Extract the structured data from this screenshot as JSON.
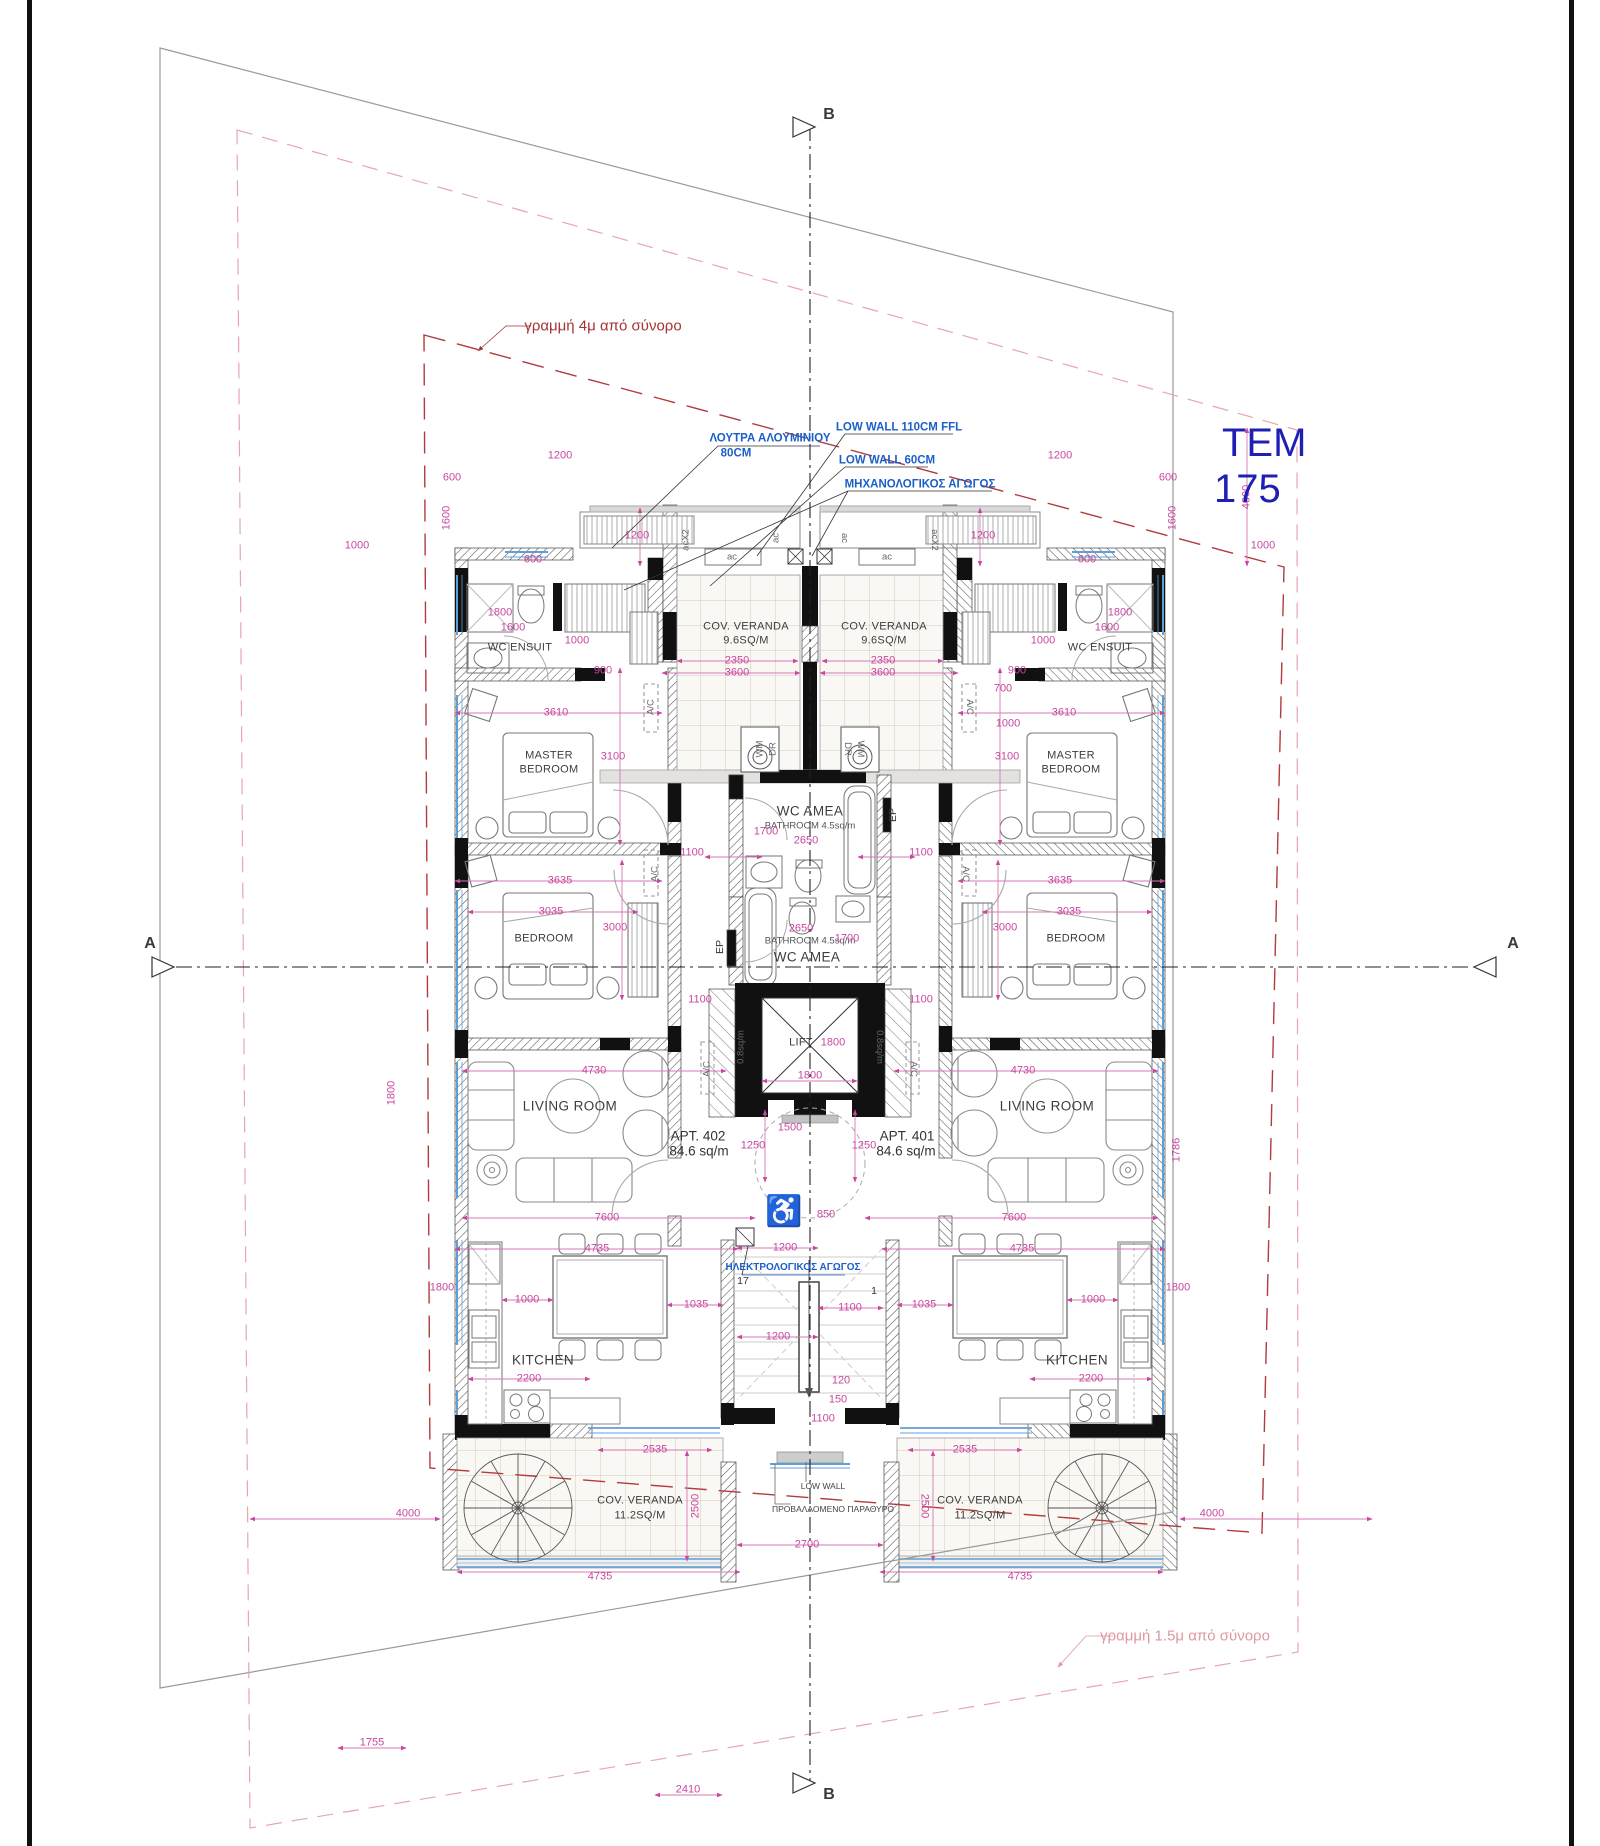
{
  "title": {
    "tem": "TEM",
    "lot_number": "175"
  },
  "apartments": [
    {
      "id": "APT. 402",
      "area": "84.6 sq/m"
    },
    {
      "id": "APT. 401",
      "area": "84.6 sq/m"
    }
  ],
  "colors": {
    "dimension_magenta": "#c9479f",
    "annotation_blue": "#1b5fc8",
    "boundary_red": "#a83232",
    "boundary_pink": "#dd98a0",
    "plot_label_blue": "#1f1fb4",
    "wall_black": "#111111",
    "window_blue": "#5f9fd6"
  },
  "annotations": [
    {
      "n": "boundary-label-4m",
      "t": "γραμμή 4μ από σύνορο",
      "x": 603,
      "y": 326,
      "c": "red"
    },
    {
      "n": "boundary-label-1-5m",
      "t": "γραμμή 1.5μ από σύνορο",
      "x": 1185,
      "y": 1636,
      "c": "pink"
    },
    {
      "n": "section-letter-a-left",
      "t": "A",
      "x": 150,
      "y": 944,
      "c": "sec"
    },
    {
      "n": "section-letter-a-right",
      "t": "A",
      "x": 1513,
      "y": 944,
      "c": "sec"
    },
    {
      "n": "section-letter-b-top",
      "t": "B",
      "x": 829,
      "y": 115,
      "c": "sec"
    },
    {
      "n": "section-letter-b-bottom",
      "t": "B",
      "x": 829,
      "y": 1795,
      "c": "sec"
    },
    {
      "n": "note-aluminium-bath",
      "t": "ΛΟΥΤΡΑ ΑΛΟΥΜΙΝΙΟΥ",
      "x": 770,
      "y": 439,
      "c": "b"
    },
    {
      "n": "note-aluminium-bath-2",
      "t": "80CM",
      "x": 736,
      "y": 454,
      "c": "b"
    },
    {
      "n": "note-low-wall-110",
      "t": "LOW WALL 110CM FFL",
      "x": 899,
      "y": 428,
      "c": "b"
    },
    {
      "n": "note-low-wall-60",
      "t": "LOW WALL 60CM",
      "x": 887,
      "y": 461,
      "c": "b"
    },
    {
      "n": "note-mechanical-duct",
      "t": "ΜΗΧΑΝΟΛΟΓΙΚΟΣ ΑΓΩΓΟΣ",
      "x": 920,
      "y": 485,
      "c": "b"
    },
    {
      "n": "note-electrical-duct",
      "t": "ΗΛΕΚΤΡΟΛΟΓΙΚΟΣ ΑΓΩΓΟΣ",
      "x": 793,
      "y": 1268,
      "c": "bs"
    },
    {
      "n": "note-low-wall-bottom",
      "t": "LOW WALL",
      "x": 823,
      "y": 1486,
      "c": "t"
    },
    {
      "n": "note-projected-window",
      "t": "ΠΡΟΒΑΛΛΟΜΕΝΟ ΠΑΡΑΘΥΡΟ",
      "x": 833,
      "y": 1509,
      "c": "t"
    },
    {
      "n": "room-wc-ensuit-l",
      "t": "WC ENSUIT",
      "x": 520,
      "y": 648,
      "c": "rs"
    },
    {
      "n": "room-wc-ensuit-r",
      "t": "WC ENSUIT",
      "x": 1100,
      "y": 648,
      "c": "rs"
    },
    {
      "n": "room-master-1-l",
      "t": "MASTER",
      "x": 549,
      "y": 756,
      "c": "rs"
    },
    {
      "n": "room-master-2-l",
      "t": "BEDROOM",
      "x": 549,
      "y": 770,
      "c": "rs"
    },
    {
      "n": "room-master-1-r",
      "t": "MASTER",
      "x": 1071,
      "y": 756,
      "c": "rs"
    },
    {
      "n": "room-master-2-r",
      "t": "BEDROOM",
      "x": 1071,
      "y": 770,
      "c": "rs"
    },
    {
      "n": "room-bedroom-l",
      "t": "BEDROOM",
      "x": 544,
      "y": 939,
      "c": "rs"
    },
    {
      "n": "room-bedroom-r",
      "t": "BEDROOM",
      "x": 1076,
      "y": 939,
      "c": "rs"
    },
    {
      "n": "room-living-l",
      "t": "LIVING ROOM",
      "x": 570,
      "y": 1106,
      "c": "r"
    },
    {
      "n": "room-living-r",
      "t": "LIVING ROOM",
      "x": 1047,
      "y": 1106,
      "c": "r"
    },
    {
      "n": "room-kitchen-l",
      "t": "KITCHEN",
      "x": 543,
      "y": 1360,
      "c": "r"
    },
    {
      "n": "room-kitchen-r",
      "t": "KITCHEN",
      "x": 1077,
      "y": 1360,
      "c": "r"
    },
    {
      "n": "room-cov-veranda-top-l",
      "t": "COV. VERANDA",
      "x": 746,
      "y": 627,
      "c": "rs"
    },
    {
      "n": "room-cov-veranda-top-l-area",
      "t": "9.6SQ/M",
      "x": 746,
      "y": 641,
      "c": "rs"
    },
    {
      "n": "room-cov-veranda-top-r",
      "t": "COV. VERANDA",
      "x": 884,
      "y": 627,
      "c": "rs"
    },
    {
      "n": "room-cov-veranda-top-r-area",
      "t": "9.6SQ/M",
      "x": 884,
      "y": 641,
      "c": "rs"
    },
    {
      "n": "room-cov-veranda-bot-l",
      "t": "COV. VERANDA",
      "x": 640,
      "y": 1501,
      "c": "rs"
    },
    {
      "n": "room-cov-veranda-bot-l-area",
      "t": "11.2SQ/M",
      "x": 640,
      "y": 1516,
      "c": "rs"
    },
    {
      "n": "room-cov-veranda-bot-r",
      "t": "COV. VERANDA",
      "x": 980,
      "y": 1501,
      "c": "rs"
    },
    {
      "n": "room-cov-veranda-bot-r-area",
      "t": "11.2SQ/M",
      "x": 980,
      "y": 1516,
      "c": "rs"
    },
    {
      "n": "room-wc-amea-upper",
      "t": "WC AMEA",
      "x": 810,
      "y": 811,
      "c": "r"
    },
    {
      "n": "room-bathroom-upper",
      "t": "BATHROOM  4.5sq/m",
      "x": 810,
      "y": 826,
      "c": "t10"
    },
    {
      "n": "room-bathroom-lower",
      "t": "BATHROOM  4.5sq/m",
      "x": 810,
      "y": 941,
      "c": "t10"
    },
    {
      "n": "room-wc-amea-lower",
      "t": "WC AMEA",
      "x": 807,
      "y": 957,
      "c": "r"
    },
    {
      "n": "room-lift",
      "t": "LIFT",
      "x": 801,
      "y": 1043,
      "c": "rs"
    },
    {
      "n": "apt-402-id",
      "t": "APT. 402",
      "x": 698,
      "y": 1136,
      "c": "apt"
    },
    {
      "n": "apt-402-area",
      "t": "84.6 sq/m",
      "x": 699,
      "y": 1151,
      "c": "apt"
    },
    {
      "n": "apt-401-id",
      "t": "APT. 401",
      "x": 907,
      "y": 1136,
      "c": "apt"
    },
    {
      "n": "apt-401-area",
      "t": "84.6 sq/m",
      "x": 906,
      "y": 1151,
      "c": "apt"
    },
    {
      "n": "label-acx2-l",
      "t": "acX2",
      "x": 686,
      "y": 540,
      "c": "ac",
      "r": -90
    },
    {
      "n": "label-acx2-r",
      "t": "acX2",
      "x": 934,
      "y": 540,
      "c": "ac",
      "r": 90
    },
    {
      "n": "label-ac-1",
      "t": "ac",
      "x": 776,
      "y": 538,
      "c": "ac",
      "r": -90
    },
    {
      "n": "label-ac-2",
      "t": "ac",
      "x": 844,
      "y": 538,
      "c": "ac",
      "r": 90
    },
    {
      "n": "label-ac-3",
      "t": "ac",
      "x": 732,
      "y": 557,
      "c": "ac"
    },
    {
      "n": "label-ac-4",
      "t": "ac",
      "x": 887,
      "y": 557,
      "c": "ac"
    },
    {
      "n": "label-wm-l",
      "t": "WM",
      "x": 760,
      "y": 749,
      "c": "ac",
      "r": -90
    },
    {
      "n": "label-dr-l",
      "t": "DR",
      "x": 773,
      "y": 749,
      "c": "ac",
      "r": -90
    },
    {
      "n": "label-dr-r",
      "t": "DR",
      "x": 847,
      "y": 749,
      "c": "ac",
      "r": 90
    },
    {
      "n": "label-wm-r",
      "t": "WM",
      "x": 860,
      "y": 749,
      "c": "ac",
      "r": 90
    },
    {
      "n": "label-ep-upper",
      "t": "EP",
      "x": 893,
      "y": 815,
      "c": "dk",
      "r": -90
    },
    {
      "n": "label-ep-lower",
      "t": "EP",
      "x": 720,
      "y": 947,
      "c": "dk",
      "r": -90
    },
    {
      "n": "label-shaft-l",
      "t": "0.8sq/m",
      "x": 741,
      "y": 1047,
      "c": "ac",
      "r": -90
    },
    {
      "n": "label-shaft-r",
      "t": "0.8sq/m",
      "x": 879,
      "y": 1047,
      "c": "ac",
      "r": 90
    },
    {
      "n": "label-ac-unit-1",
      "t": "A/C",
      "x": 651,
      "y": 707,
      "c": "ac",
      "r": -90
    },
    {
      "n": "label-ac-unit-2",
      "t": "A/C",
      "x": 969,
      "y": 707,
      "c": "ac",
      "r": 90
    },
    {
      "n": "label-ac-unit-3",
      "t": "A/C",
      "x": 655,
      "y": 874,
      "c": "ac",
      "r": -90
    },
    {
      "n": "label-ac-unit-4",
      "t": "A/C",
      "x": 965,
      "y": 874,
      "c": "ac",
      "r": 90
    },
    {
      "n": "label-ac-unit-5",
      "t": "A/C",
      "x": 707,
      "y": 1069,
      "c": "ac",
      "r": -90
    },
    {
      "n": "label-ac-unit-6",
      "t": "A/C",
      "x": 913,
      "y": 1069,
      "c": "ac",
      "r": 90
    },
    {
      "n": "stair-number-17",
      "t": "17",
      "x": 743,
      "y": 1281,
      "c": "dk"
    },
    {
      "n": "stair-number-1",
      "t": "1",
      "x": 874,
      "y": 1291,
      "c": "dk"
    },
    {
      "n": "wheelchair-icon",
      "t": "♿",
      "x": 784,
      "y": 1212,
      "c": "wh"
    },
    {
      "n": "dim-1200-vtl",
      "t": "1200",
      "x": 637,
      "y": 536,
      "c": "d"
    },
    {
      "n": "dim-1200-vtr",
      "t": "1200",
      "x": 983,
      "y": 536,
      "c": "d"
    },
    {
      "n": "dim-1200-tl",
      "t": "1200",
      "x": 560,
      "y": 456,
      "c": "d"
    },
    {
      "n": "dim-1200-tr",
      "t": "1200",
      "x": 1060,
      "y": 456,
      "c": "d"
    },
    {
      "n": "dim-600-tl",
      "t": "600",
      "x": 452,
      "y": 478,
      "c": "d"
    },
    {
      "n": "dim-600-tr",
      "t": "600",
      "x": 1168,
      "y": 478,
      "c": "d"
    },
    {
      "n": "dim-1600-wl",
      "t": "1600",
      "x": 447,
      "y": 518,
      "c": "d",
      "r": -90
    },
    {
      "n": "dim-1600-wr",
      "t": "1600",
      "x": 1173,
      "y": 518,
      "c": "d",
      "r": -90
    },
    {
      "n": "dim-1000-otl",
      "t": "1000",
      "x": 357,
      "y": 546,
      "c": "d"
    },
    {
      "n": "dim-1000-otr",
      "t": "1000",
      "x": 1263,
      "y": 546,
      "c": "d"
    },
    {
      "n": "dim-600-sl",
      "t": "600",
      "x": 533,
      "y": 560,
      "c": "d"
    },
    {
      "n": "dim-600-sr",
      "t": "600",
      "x": 1087,
      "y": 560,
      "c": "d"
    },
    {
      "n": "dim-1800-el",
      "t": "1800",
      "x": 500,
      "y": 613,
      "c": "d"
    },
    {
      "n": "dim-1800-er",
      "t": "1800",
      "x": 1120,
      "y": 613,
      "c": "d"
    },
    {
      "n": "dim-1600-el",
      "t": "1600",
      "x": 513,
      "y": 628,
      "c": "d"
    },
    {
      "n": "dim-1600-er",
      "t": "1600",
      "x": 1107,
      "y": 628,
      "c": "d"
    },
    {
      "n": "dim-1000-el",
      "t": "1000",
      "x": 577,
      "y": 641,
      "c": "d"
    },
    {
      "n": "dim-1000-er",
      "t": "1000",
      "x": 1043,
      "y": 641,
      "c": "d"
    },
    {
      "n": "dim-900-l",
      "t": "900",
      "x": 603,
      "y": 671,
      "c": "d"
    },
    {
      "n": "dim-900-r",
      "t": "900",
      "x": 1017,
      "y": 671,
      "c": "d"
    },
    {
      "n": "dim-2350-l",
      "t": "2350",
      "x": 737,
      "y": 661,
      "c": "d"
    },
    {
      "n": "dim-2350-r",
      "t": "2350",
      "x": 883,
      "y": 661,
      "c": "d"
    },
    {
      "n": "dim-3600-l",
      "t": "3600",
      "x": 737,
      "y": 673,
      "c": "d"
    },
    {
      "n": "dim-3600-r",
      "t": "3600",
      "x": 883,
      "y": 673,
      "c": "d"
    },
    {
      "n": "dim-3610-l",
      "t": "3610",
      "x": 556,
      "y": 713,
      "c": "d"
    },
    {
      "n": "dim-3610-r",
      "t": "3610",
      "x": 1064,
      "y": 713,
      "c": "d"
    },
    {
      "n": "dim-3100-l",
      "t": "3100",
      "x": 613,
      "y": 757,
      "c": "d"
    },
    {
      "n": "dim-3100-r",
      "t": "3100",
      "x": 1007,
      "y": 757,
      "c": "d"
    },
    {
      "n": "dim-700-r",
      "t": "700",
      "x": 1003,
      "y": 689,
      "c": "d"
    },
    {
      "n": "dim-1000-r2",
      "t": "1000",
      "x": 1008,
      "y": 724,
      "c": "d"
    },
    {
      "n": "dim-1100-ubl",
      "t": "1100",
      "x": 692,
      "y": 853,
      "c": "d"
    },
    {
      "n": "dim-1100-ubr",
      "t": "1100",
      "x": 921,
      "y": 853,
      "c": "d"
    },
    {
      "n": "dim-1700-ub",
      "t": "1700",
      "x": 766,
      "y": 832,
      "c": "d"
    },
    {
      "n": "dim-2650-ub",
      "t": "2650",
      "x": 806,
      "y": 841,
      "c": "d"
    },
    {
      "n": "dim-3635-l",
      "t": "3635",
      "x": 560,
      "y": 881,
      "c": "d"
    },
    {
      "n": "dim-3635-r",
      "t": "3635",
      "x": 1060,
      "y": 881,
      "c": "d"
    },
    {
      "n": "dim-3035-l",
      "t": "3035",
      "x": 551,
      "y": 912,
      "c": "d"
    },
    {
      "n": "dim-3035-r",
      "t": "3035",
      "x": 1069,
      "y": 912,
      "c": "d"
    },
    {
      "n": "dim-3000-l",
      "t": "3000",
      "x": 615,
      "y": 928,
      "c": "d"
    },
    {
      "n": "dim-3000-r",
      "t": "3000",
      "x": 1005,
      "y": 928,
      "c": "d"
    },
    {
      "n": "dim-2650-lb",
      "t": "2650",
      "x": 801,
      "y": 929,
      "c": "d"
    },
    {
      "n": "dim-1700-lb",
      "t": "1700",
      "x": 847,
      "y": 939,
      "c": "d"
    },
    {
      "n": "dim-1100-lbl",
      "t": "1100",
      "x": 700,
      "y": 1000,
      "c": "d"
    },
    {
      "n": "dim-1100-lbr",
      "t": "1100",
      "x": 921,
      "y": 1000,
      "c": "d"
    },
    {
      "n": "dim-1800-lift1",
      "t": "1800",
      "x": 833,
      "y": 1043,
      "c": "d"
    },
    {
      "n": "dim-1800-lift2",
      "t": "1800",
      "x": 810,
      "y": 1076,
      "c": "d"
    },
    {
      "n": "dim-1250-l",
      "t": "1250",
      "x": 753,
      "y": 1146,
      "c": "d"
    },
    {
      "n": "dim-1250-r",
      "t": "1250",
      "x": 864,
      "y": 1146,
      "c": "d"
    },
    {
      "n": "dim-1500",
      "t": "1500",
      "x": 790,
      "y": 1128,
      "c": "d"
    },
    {
      "n": "dim-4730-l",
      "t": "4730",
      "x": 594,
      "y": 1071,
      "c": "d"
    },
    {
      "n": "dim-4730-r",
      "t": "4730",
      "x": 1023,
      "y": 1071,
      "c": "d"
    },
    {
      "n": "dim-1786-r",
      "t": "1786",
      "x": 1177,
      "y": 1150,
      "c": "d",
      "r": -90
    },
    {
      "n": "dim-1800-lw",
      "t": "1800",
      "x": 392,
      "y": 1093,
      "c": "d",
      "r": -90
    },
    {
      "n": "dim-7600-l",
      "t": "7600",
      "x": 607,
      "y": 1218,
      "c": "d"
    },
    {
      "n": "dim-7600-r",
      "t": "7600",
      "x": 1014,
      "y": 1218,
      "c": "d"
    },
    {
      "n": "dim-850",
      "t": "850",
      "x": 826,
      "y": 1215,
      "c": "d"
    },
    {
      "n": "dim-1200-lobby",
      "t": "1200",
      "x": 785,
      "y": 1248,
      "c": "d"
    },
    {
      "n": "dim-4735-l",
      "t": "4735",
      "x": 597,
      "y": 1249,
      "c": "d"
    },
    {
      "n": "dim-4735-r",
      "t": "4735",
      "x": 1022,
      "y": 1249,
      "c": "d"
    },
    {
      "n": "dim-1800-kl",
      "t": "1800",
      "x": 442,
      "y": 1288,
      "c": "d"
    },
    {
      "n": "dim-1800-kr",
      "t": "1800",
      "x": 1178,
      "y": 1288,
      "c": "d"
    },
    {
      "n": "dim-1000-kl",
      "t": "1000",
      "x": 527,
      "y": 1300,
      "c": "d"
    },
    {
      "n": "dim-1000-kr",
      "t": "1000",
      "x": 1093,
      "y": 1300,
      "c": "d"
    },
    {
      "n": "dim-1035-l",
      "t": "1035",
      "x": 696,
      "y": 1305,
      "c": "d"
    },
    {
      "n": "dim-1035-r",
      "t": "1035",
      "x": 924,
      "y": 1305,
      "c": "d"
    },
    {
      "n": "dim-1100-st1",
      "t": "1100",
      "x": 850,
      "y": 1308,
      "c": "d"
    },
    {
      "n": "dim-1200-st",
      "t": "1200",
      "x": 778,
      "y": 1337,
      "c": "d"
    },
    {
      "n": "dim-120-st",
      "t": "120",
      "x": 841,
      "y": 1381,
      "c": "d"
    },
    {
      "n": "dim-150-st",
      "t": "150",
      "x": 838,
      "y": 1400,
      "c": "d"
    },
    {
      "n": "dim-1100-st2",
      "t": "1100",
      "x": 823,
      "y": 1419,
      "c": "d"
    },
    {
      "n": "dim-2200-l",
      "t": "2200",
      "x": 529,
      "y": 1379,
      "c": "d"
    },
    {
      "n": "dim-2200-r",
      "t": "2200",
      "x": 1091,
      "y": 1379,
      "c": "d"
    },
    {
      "n": "dim-2535-l",
      "t": "2535",
      "x": 655,
      "y": 1450,
      "c": "d"
    },
    {
      "n": "dim-2535-r",
      "t": "2535",
      "x": 965,
      "y": 1450,
      "c": "d"
    },
    {
      "n": "dim-2500-l",
      "t": "2500",
      "x": 696,
      "y": 1506,
      "c": "d",
      "r": -90
    },
    {
      "n": "dim-2500-r",
      "t": "2500",
      "x": 924,
      "y": 1506,
      "c": "d",
      "r": 90
    },
    {
      "n": "dim-2700",
      "t": "2700",
      "x": 807,
      "y": 1545,
      "c": "d"
    },
    {
      "n": "dim-4735-bl",
      "t": "4735",
      "x": 600,
      "y": 1577,
      "c": "d"
    },
    {
      "n": "dim-4735-br",
      "t": "4735",
      "x": 1020,
      "y": 1577,
      "c": "d"
    },
    {
      "n": "dim-4000-bl",
      "t": "4000",
      "x": 408,
      "y": 1514,
      "c": "d"
    },
    {
      "n": "dim-4000-br",
      "t": "4000",
      "x": 1212,
      "y": 1514,
      "c": "d"
    },
    {
      "n": "dim-4000-tr",
      "t": "4000",
      "x": 1247,
      "y": 497,
      "c": "d",
      "r": -90
    },
    {
      "n": "dim-1755",
      "t": "1755",
      "x": 372,
      "y": 1743,
      "c": "d"
    },
    {
      "n": "dim-2410",
      "t": "2410",
      "x": 688,
      "y": 1790,
      "c": "d"
    }
  ]
}
